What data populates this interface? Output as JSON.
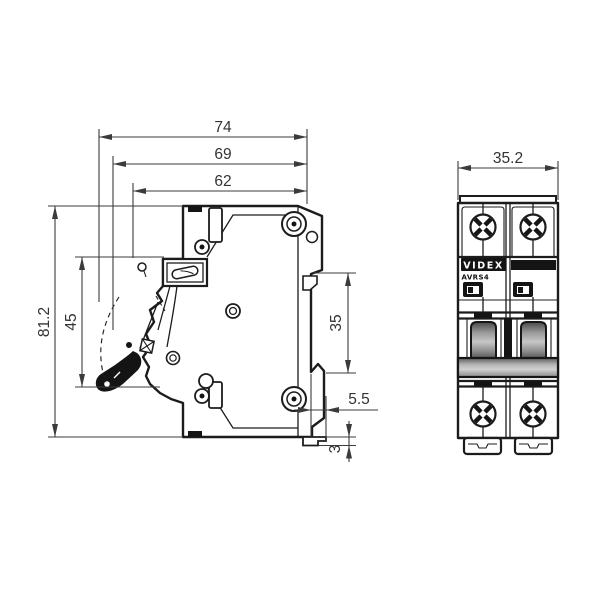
{
  "canvas": {
    "width": 600,
    "height": 600,
    "background": "#ffffff"
  },
  "side_view": {
    "description": "circuit breaker side profile with DIN rail mount",
    "dimensions": {
      "depth_total": "74",
      "depth_upper": "69",
      "depth_body": "62",
      "height_total": "81.2",
      "height_front_section": "45",
      "din_recess_height": "35",
      "din_clip_offset": "5.5",
      "din_clip_height": "3"
    }
  },
  "front_view": {
    "description": "2-pole circuit breaker front face",
    "dimensions": {
      "width_total": "35.2"
    },
    "label": {
      "brand": "VIDEX",
      "model": "AVRS4"
    }
  },
  "colors": {
    "line": "#1c1c1c",
    "dimension": "#3b3b3b",
    "label_background": "#141414",
    "label_text": "#ffffff",
    "lever_dark": "#4a4a4a",
    "lever_light": "#c6c6c6",
    "tie_bar_light": "#d0d0d0",
    "background": "#ffffff"
  }
}
